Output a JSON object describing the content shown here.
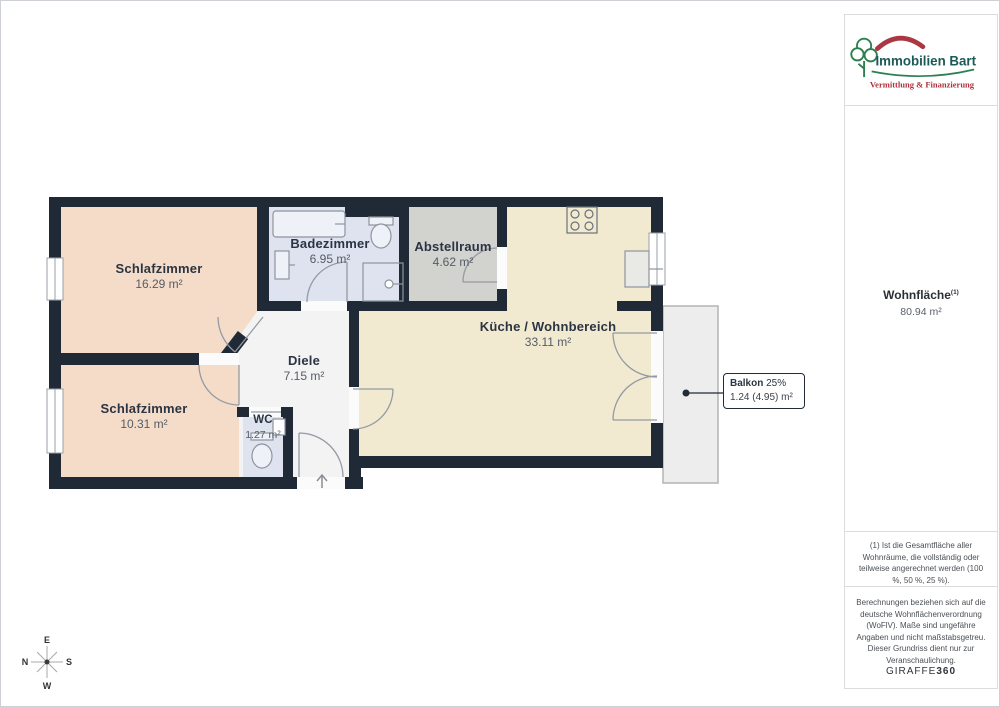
{
  "brand": {
    "name": "Immobilien Bart",
    "tagline": "Vermittlung & Finanzierung",
    "colors": {
      "teal": "#1b5a58",
      "red": "#ae303c",
      "green": "#2e8050"
    }
  },
  "sidebar": {
    "living_area": {
      "label": "Wohnfläche",
      "sup": "(1)",
      "value": "80.94 m²"
    },
    "footnote": "(1) Ist die Gesamtfläche aller Wohnräume, die vollständig oder teilweise angerechnet werden (100 %, 50 %, 25 %).",
    "disclaimer": "Berechnungen beziehen sich auf die deutsche Wohnflächenverordnung (WoFlV). Maße sind ungefähre Angaben und nicht maßstabsgetreu. Dieser Grundriss dient nur zur Veranschaulichung.",
    "watermark_normal": "GIRAFFE",
    "watermark_bold": "360"
  },
  "floorplan": {
    "rooms": [
      {
        "id": "schlafzimmer-1",
        "name": "Schlafzimmer",
        "area": "16.29 m²"
      },
      {
        "id": "schlafzimmer-2",
        "name": "Schlafzimmer",
        "area": "10.31 m²"
      },
      {
        "id": "badezimmer",
        "name": "Badezimmer",
        "area": "6.95 m²"
      },
      {
        "id": "abstellraum",
        "name": "Abstellraum",
        "area": "4.62 m²"
      },
      {
        "id": "kueche",
        "name": "Küche / Wohnbereich",
        "area": "33.11 m²"
      },
      {
        "id": "diele",
        "name": "Diele",
        "area": "7.15 m²"
      },
      {
        "id": "wc",
        "name": "WC",
        "area": "1.27 m²"
      }
    ],
    "balcony": {
      "name": "Balkon",
      "percent": "25%",
      "area": "1.24 (4.95) m²"
    },
    "colors": {
      "wall": "#202a36",
      "bedroom": "#f4dcc8",
      "kitchen": "#f1ead1",
      "bath": "#dee3ef",
      "storage": "#d2d2cf",
      "hall": "#f3f3f4",
      "balcony": "#ededee"
    }
  },
  "compass": {
    "n": "N",
    "e": "E",
    "s": "S",
    "w": "W"
  }
}
